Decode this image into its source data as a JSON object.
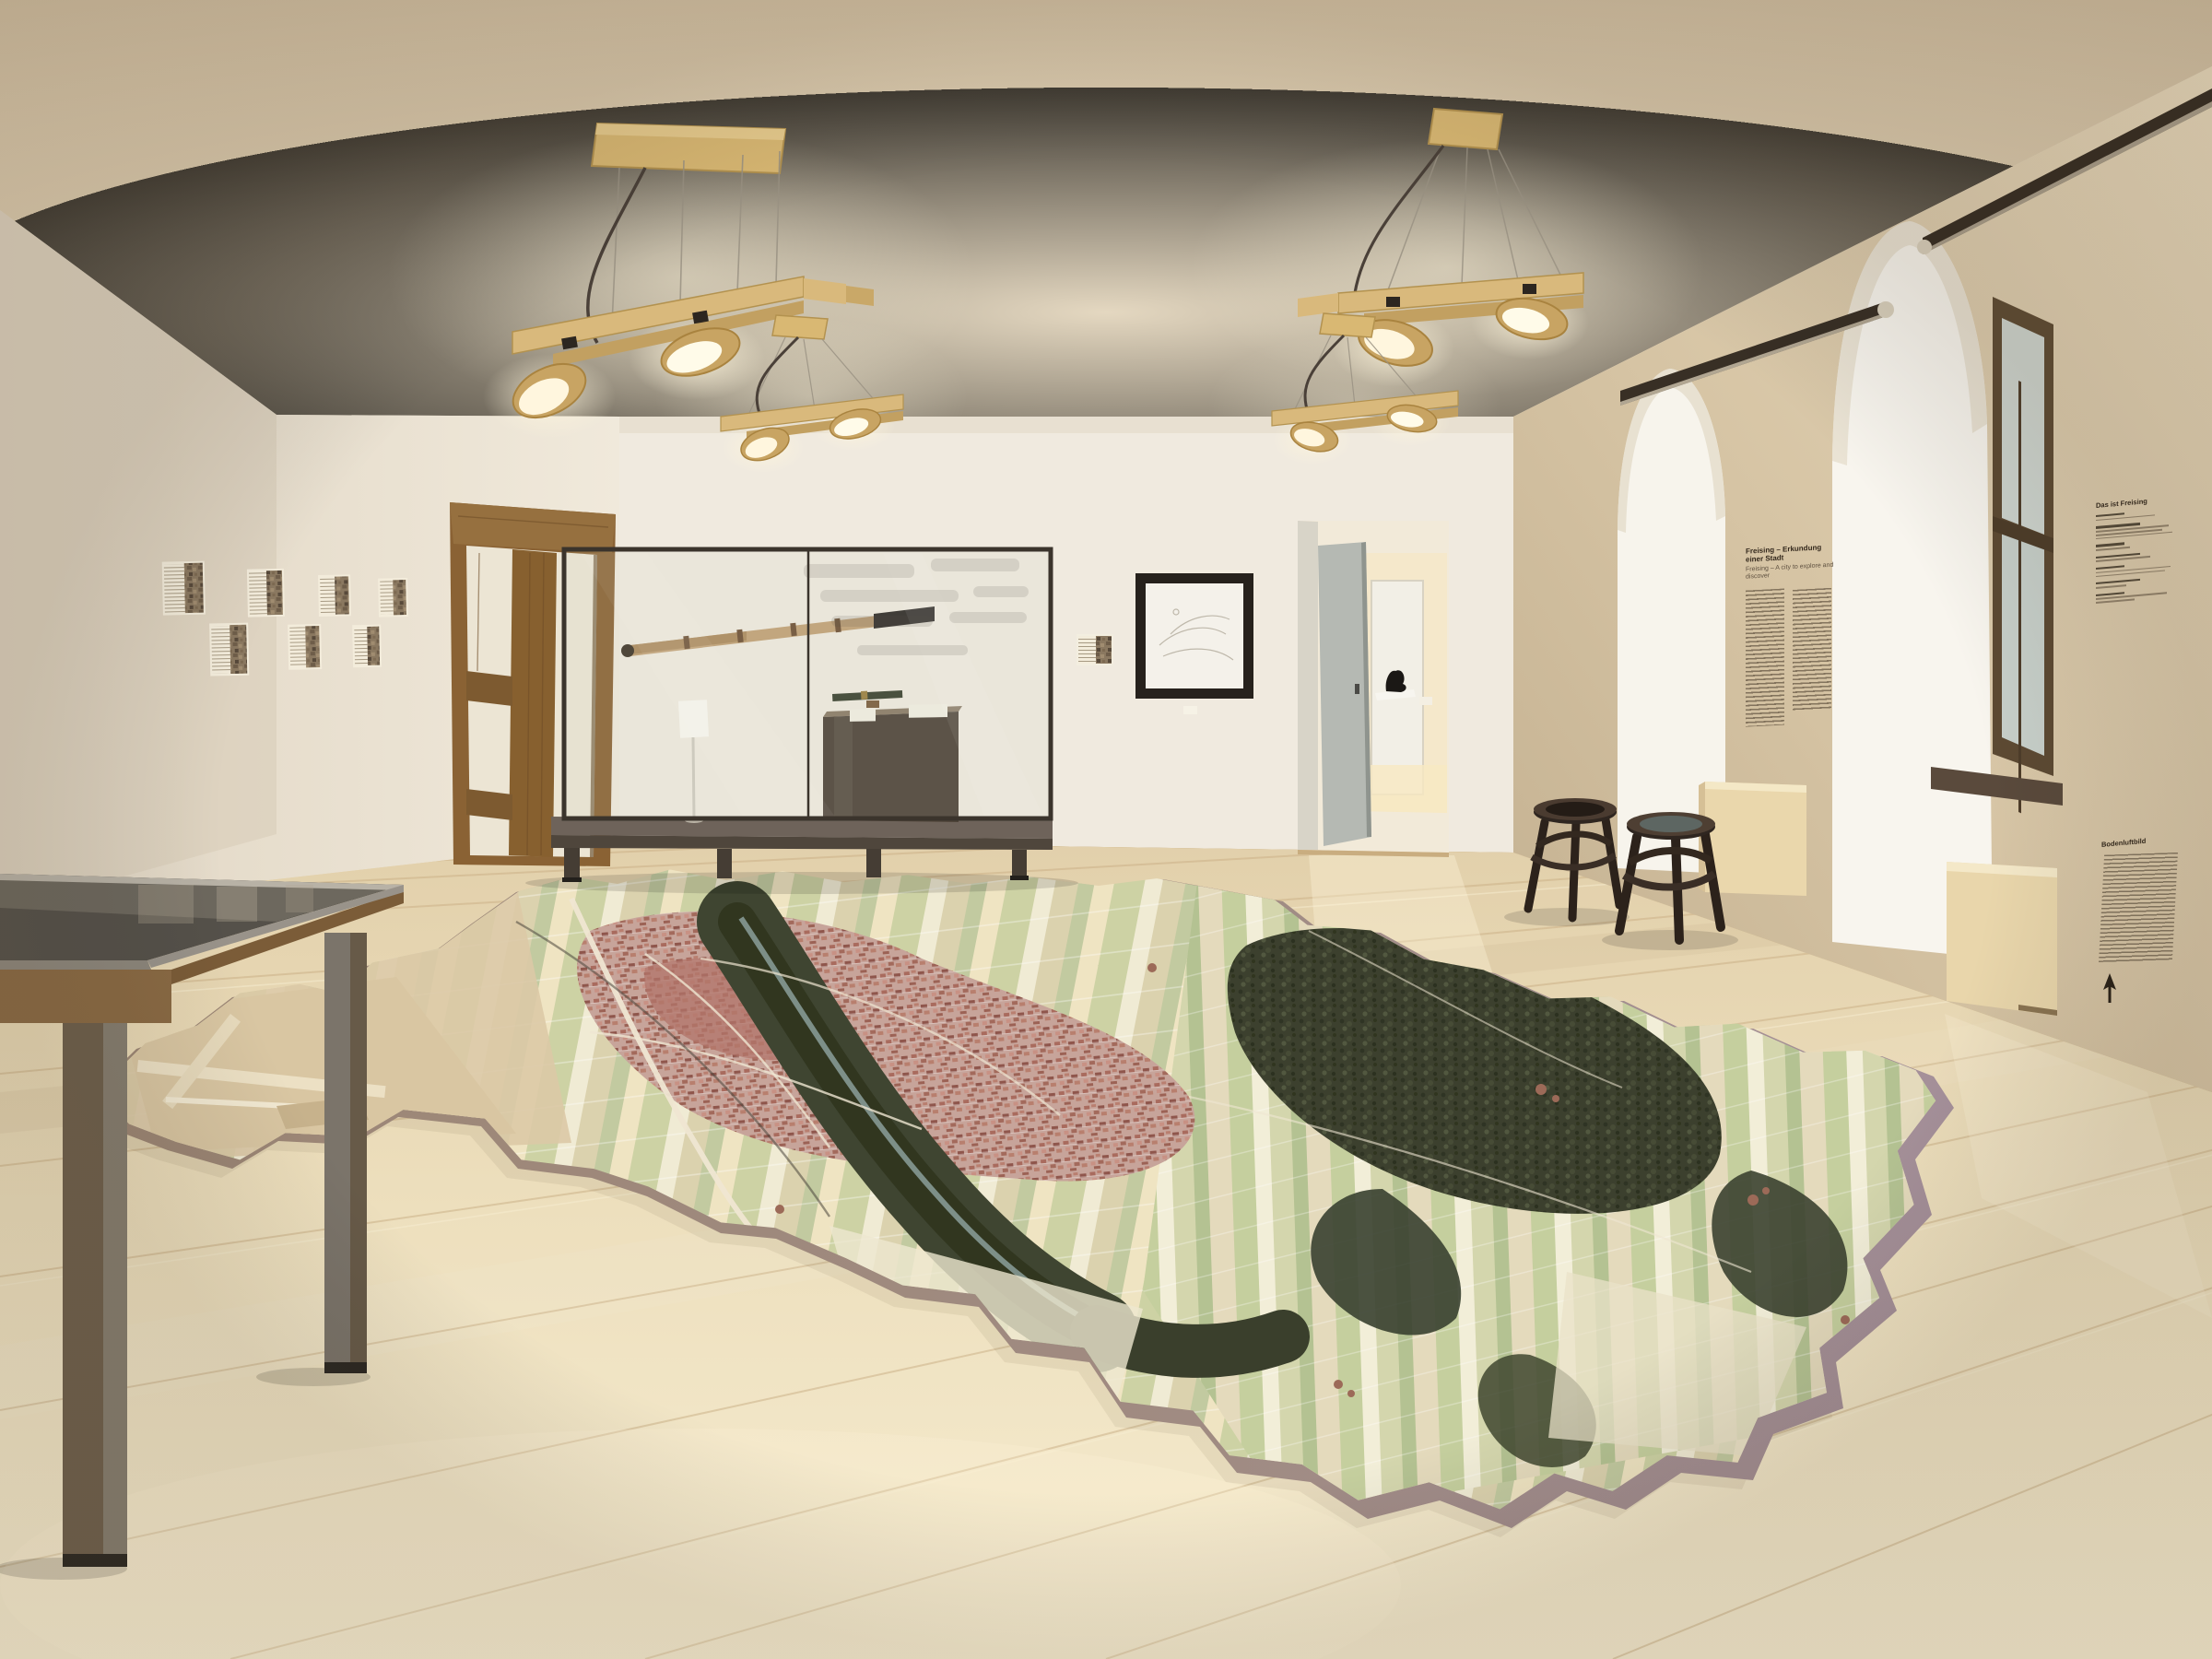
{
  "room": {
    "wall_texts": {
      "city_panel": {
        "title_de": "Freising – Erkundung einer Stadt",
        "title_en": "Freising – A city to explore and discover"
      },
      "facts_panel": {
        "title": "Das ist Freising"
      },
      "aerial_panel": {
        "title": "Bodenluftbild"
      }
    },
    "icons": {
      "north_arrow": "compass-north-arrow"
    },
    "colors": {
      "ceiling": "#decfb4",
      "wall_white": "#efe9dd",
      "wall_tan": "#d5c3a4",
      "floor_wood": "#eedfbd",
      "map_felt": "#a18c85",
      "map_fields": "#dcd4b4",
      "map_city": "#c29a8e",
      "map_forest": "#3c402e",
      "fixture_wood": "#d8b77a",
      "vitrine_metal": "#463e34",
      "stool_wood": "#2f251e",
      "table_metal": "#8b8478",
      "table_wood": "#8a6a44"
    }
  }
}
